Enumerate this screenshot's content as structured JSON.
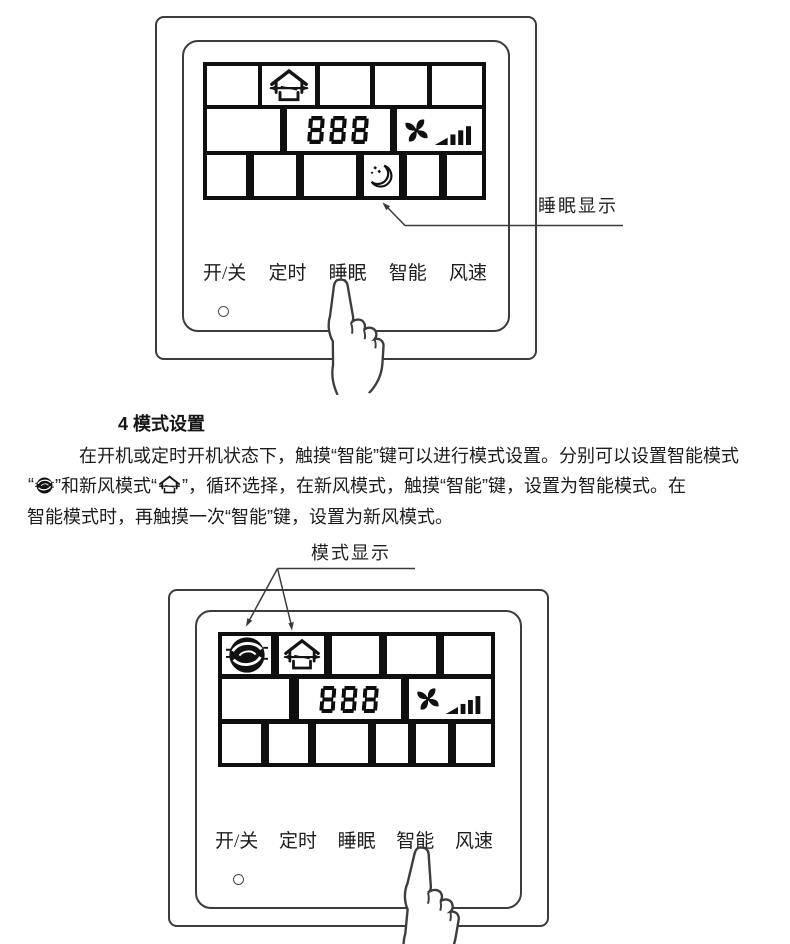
{
  "document": {
    "type": "product-manual-page",
    "language": "zh-CN"
  },
  "colors": {
    "ink": "#1f1f1f",
    "line_art": "#3c3c3c",
    "lcd_grid": "#0f0f0f",
    "background": "#ffffff"
  },
  "top_figure": {
    "annotation_label": "睡眠显示",
    "lcd_value": "888",
    "buttons": [
      "开/关",
      "定时",
      "睡眠",
      "智能",
      "风速"
    ],
    "icons": {
      "fresh_air_mode": "house-with-airflow-arrow",
      "fan_speed": "pinwheel-fan-with-rising-bars",
      "sleep": "crescent-moon-with-stars"
    },
    "pointing_at_button": "睡眠"
  },
  "section": {
    "heading": "4 模式设置",
    "line1": "在开机或定时开机状态下，触摸“智能”键可以进行模式设置。分别可以设置智能模式",
    "line2_open": "“",
    "line2_mid": "”和新风模式“",
    "line2_end": "”，循环选择，在新风模式，触摸“智能”键，设置为智能模式。在",
    "line3": "智能模式时，再触摸一次“智能”键，设置为新风模式。"
  },
  "bottom_figure": {
    "annotation_label": "模式显示",
    "lcd_value": "888",
    "buttons": [
      "开/关",
      "定时",
      "睡眠",
      "智能",
      "风速"
    ],
    "icons": {
      "smart_mode": "filled-circle-swirl",
      "fresh_air_mode": "house-with-airflow-arrow",
      "fan_speed": "pinwheel-fan-with-rising-bars"
    },
    "pointing_at_button": "智能"
  }
}
